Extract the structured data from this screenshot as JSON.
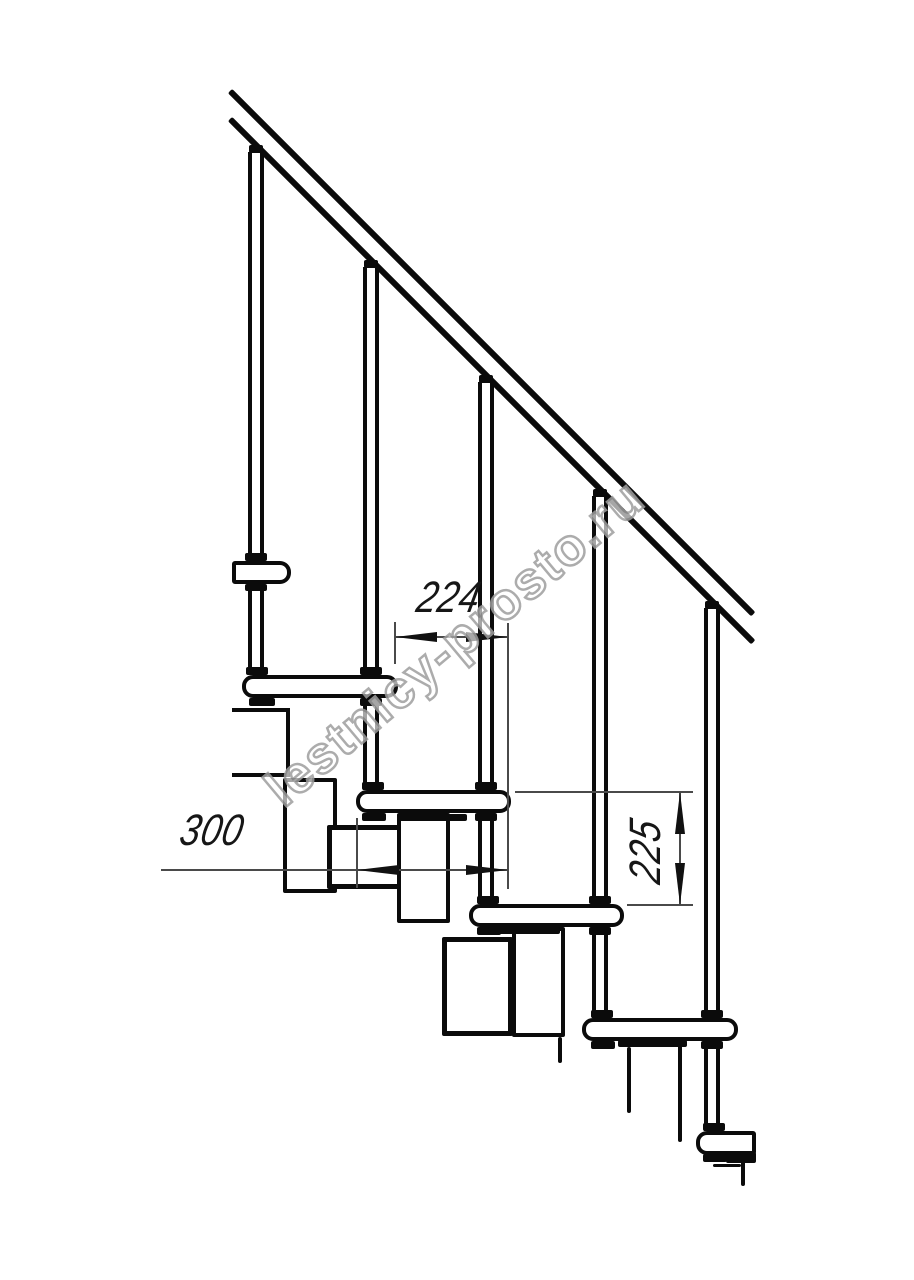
{
  "title": "Modular staircase side elevation drawing",
  "dims": {
    "d224": {
      "label": "224",
      "meaning": "tread horizontal pitch"
    },
    "d300": {
      "label": "300",
      "meaning": "tread depth"
    },
    "d225": {
      "label": "225",
      "meaning": "riser height"
    }
  },
  "watermark": {
    "text": "lestnicy-prosto.ru"
  },
  "colors": {
    "line": "#0b0b0b",
    "thin": "#4a4a4a",
    "watermark": "#9e9e9e",
    "background": "#ffffff"
  },
  "drawing": {
    "rails": [
      {
        "x": 230,
        "y": 88,
        "len": 740
      },
      {
        "x": 230,
        "y": 116,
        "len": 740
      }
    ],
    "balusters": [
      {
        "x": 248,
        "y": 152,
        "h": 523
      },
      {
        "x": 363,
        "y": 267,
        "h": 523
      },
      {
        "x": 478,
        "y": 382,
        "h": 522
      },
      {
        "x": 592,
        "y": 496,
        "h": 522
      },
      {
        "x": 704,
        "y": 608,
        "h": 523
      }
    ],
    "modules": [
      {
        "x": 232,
        "y": 708,
        "w": 58,
        "h": 69,
        "cls": "no-left"
      },
      {
        "x": 283,
        "y": 778,
        "w": 54,
        "h": 115,
        "cls": ""
      },
      {
        "x": 327,
        "y": 825,
        "w": 76,
        "h": 64,
        "cls": "thick"
      },
      {
        "x": 397,
        "y": 813,
        "w": 53,
        "h": 110,
        "cls": ""
      },
      {
        "x": 442,
        "y": 937,
        "w": 71,
        "h": 99,
        "cls": "thick"
      },
      {
        "x": 512,
        "y": 927,
        "w": 53,
        "h": 110,
        "cls": ""
      }
    ],
    "barelines": [
      [
        627,
        1047,
        4,
        66
      ],
      [
        678,
        1045,
        4,
        97
      ],
      [
        713,
        1164,
        28,
        3
      ],
      [
        741,
        1161,
        4,
        25
      ],
      [
        558,
        1037,
        4,
        26
      ]
    ],
    "treads": [
      {
        "x": 232,
        "y": 561,
        "w": 59,
        "h": 23,
        "round": "right"
      },
      {
        "x": 242,
        "y": 675,
        "w": 156,
        "h": 23,
        "round": "both"
      },
      {
        "x": 356,
        "y": 790,
        "w": 155,
        "h": 23,
        "round": "both"
      },
      {
        "x": 469,
        "y": 904,
        "w": 155,
        "h": 23,
        "round": "both"
      },
      {
        "x": 582,
        "y": 1018,
        "w": 156,
        "h": 23,
        "round": "both"
      },
      {
        "x": 696,
        "y": 1131,
        "w": 60,
        "h": 24,
        "round": "left"
      }
    ],
    "caps": [
      [
        249,
        145,
        14,
        8
      ],
      [
        364,
        260,
        14,
        8
      ],
      [
        479,
        375,
        14,
        8
      ],
      [
        593,
        489,
        14,
        8
      ],
      [
        705,
        601,
        14,
        8
      ]
    ],
    "collars": [
      [
        245,
        553,
        22,
        8
      ],
      [
        245,
        584,
        22,
        7
      ],
      [
        246,
        667,
        22,
        8
      ],
      [
        249,
        698,
        26,
        8
      ],
      [
        360,
        667,
        22,
        8
      ],
      [
        360,
        698,
        22,
        8
      ],
      [
        362,
        782,
        22,
        8
      ],
      [
        362,
        813,
        24,
        8
      ],
      [
        475,
        782,
        22,
        8
      ],
      [
        475,
        813,
        22,
        8
      ],
      [
        477,
        896,
        22,
        8
      ],
      [
        477,
        927,
        24,
        8
      ],
      [
        589,
        896,
        22,
        8
      ],
      [
        589,
        927,
        22,
        8
      ],
      [
        591,
        1010,
        22,
        8
      ],
      [
        591,
        1041,
        24,
        8
      ],
      [
        701,
        1010,
        22,
        8
      ],
      [
        701,
        1041,
        22,
        8
      ],
      [
        703,
        1123,
        22,
        8
      ],
      [
        703,
        1154,
        24,
        8
      ]
    ],
    "plates": [
      [
        397,
        814,
        70,
        7
      ],
      [
        488,
        927,
        72,
        7
      ],
      [
        618,
        1040,
        69,
        7
      ],
      [
        726,
        1152,
        30,
        11
      ]
    ],
    "dimlines": [
      [
        395,
        636,
        113,
        2
      ],
      [
        161,
        869,
        347,
        2
      ],
      [
        679,
        792,
        2,
        113
      ]
    ],
    "extlines": [
      [
        394,
        622,
        2,
        42
      ],
      [
        507,
        623,
        2,
        266
      ],
      [
        356,
        818,
        2,
        70
      ],
      [
        515,
        791,
        178,
        2
      ],
      [
        627,
        904,
        66,
        2
      ]
    ],
    "arrows": [
      {
        "t": "left",
        "x": 395,
        "y": 632
      },
      {
        "t": "right",
        "x": 466,
        "y": 632
      },
      {
        "t": "left",
        "x": 357,
        "y": 865
      },
      {
        "t": "right",
        "x": 466,
        "y": 865
      },
      {
        "t": "up",
        "x": 675,
        "y": 792
      },
      {
        "t": "down",
        "x": 675,
        "y": 863
      }
    ]
  }
}
